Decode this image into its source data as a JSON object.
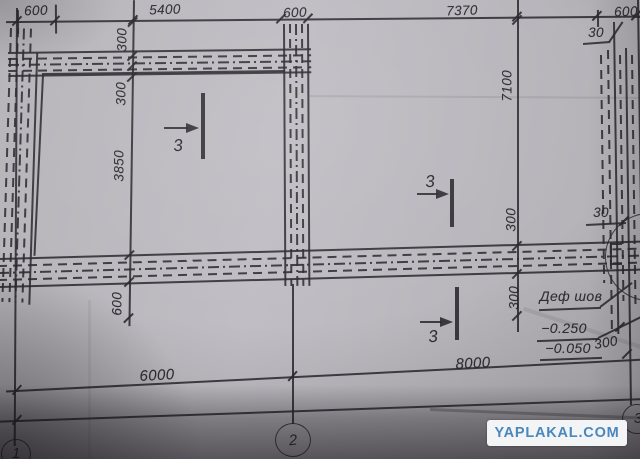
{
  "dims": {
    "top": [
      "600",
      "5400",
      "600",
      "7370",
      "600"
    ],
    "left": [
      "300",
      "300",
      "3850",
      "600"
    ],
    "right_chain": [
      "7100",
      "300",
      "300"
    ],
    "bottom": [
      "6000",
      "8000"
    ],
    "callout_30_top": "30",
    "callout_30_mid": "30",
    "callout_300_right": "300"
  },
  "labels": {
    "def_joint": "Деф шов",
    "elev_upper": "−0.250",
    "elev_lower": "−0.050"
  },
  "sections": {
    "s1": "3",
    "s2": "3",
    "s3": "3"
  },
  "bubbles": {
    "b1": "1",
    "b2": "2",
    "b3": "3"
  },
  "watermark": {
    "text": "YAPLAKAL.COM"
  },
  "colors": {
    "paper": "#b9b6bc",
    "ink": "#2c2b31",
    "watermark_text": "#4a87bd",
    "watermark_bg": "#f3f4f6"
  }
}
